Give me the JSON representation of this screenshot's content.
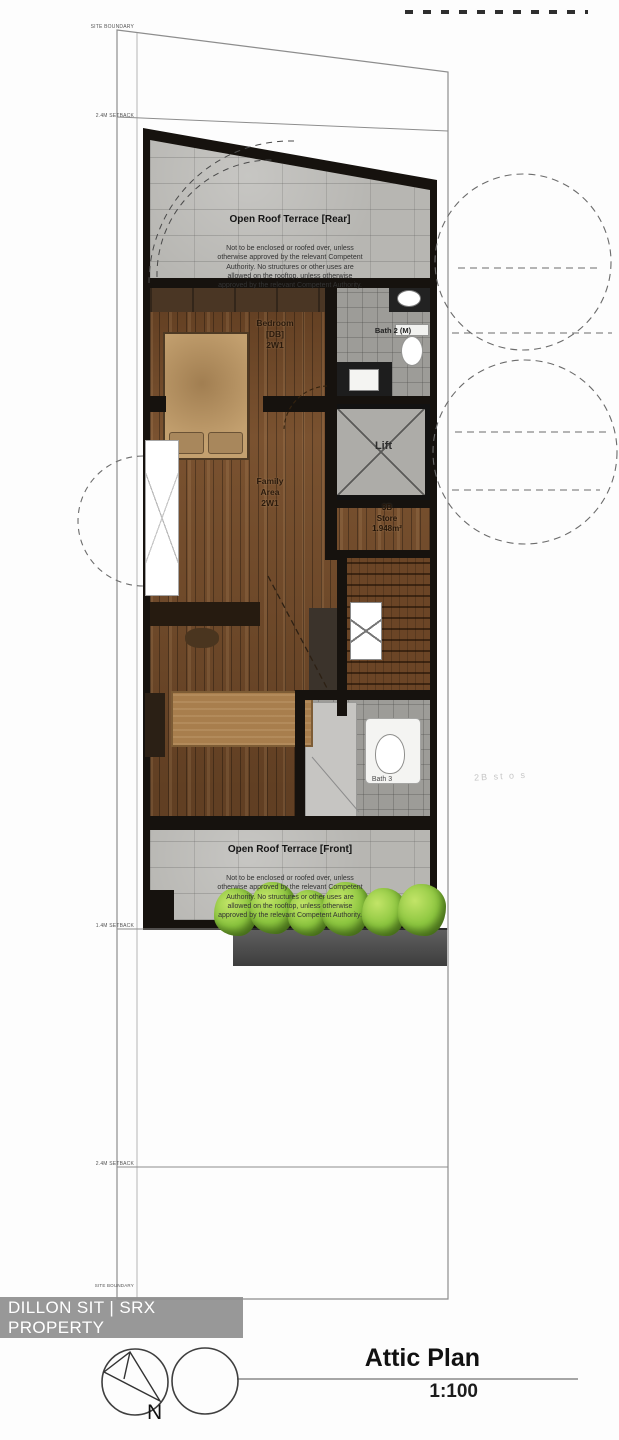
{
  "watermark": {
    "text": "DILLON SIT | SRX PROPERTY"
  },
  "title_block": {
    "title": "Attic Plan",
    "scale": "1:100",
    "north": "N"
  },
  "annotations": {
    "site_boundary_top": "SITE BOUNDARY",
    "setback_top": "2.4M SETBACK",
    "setback_mid": "1.4M SETBACK",
    "setback_low": "2.4M SETBACK",
    "site_boundary_bottom": "SITE BOUNDARY",
    "faint_note": "2B st o s"
  },
  "rooms": {
    "terrace_rear": {
      "title": "Open Roof Terrace [Rear]",
      "body": "Not to be enclosed or roofed over, unless\notherwise approved by the relevant Competent\nAuthority. No structures or other uses are\nallowed on the rooftop, unless otherwise\napproved by the relevant Competent Authority."
    },
    "terrace_front": {
      "title": "Open Roof Terrace [Front]",
      "body": "Not to be enclosed or roofed over, unless\notherwise approved by the relevant Competent\nAuthority. No structures or other uses are\nallowed on the rooftop, unless otherwise\napproved by the relevant Competent Authority."
    },
    "bedroom": {
      "label": "Bedroom\n[DB]\n2W1"
    },
    "family_area": {
      "label": "Family\nArea\n2W1"
    },
    "store": {
      "label": "3B\nStore\n1.948m²"
    },
    "lift": {
      "label": "Lift"
    },
    "bath_top": {
      "label": "Bath 2 (M)"
    },
    "bath_bottom": {
      "label": "Bath 3"
    }
  },
  "colors": {
    "wood": "#7a5230",
    "concrete": "#b7b6b2",
    "tile": "#9d9c98",
    "wall": "#16120e",
    "plant_green": "#8cc63f",
    "banner_gray": "#8f8f8f"
  }
}
